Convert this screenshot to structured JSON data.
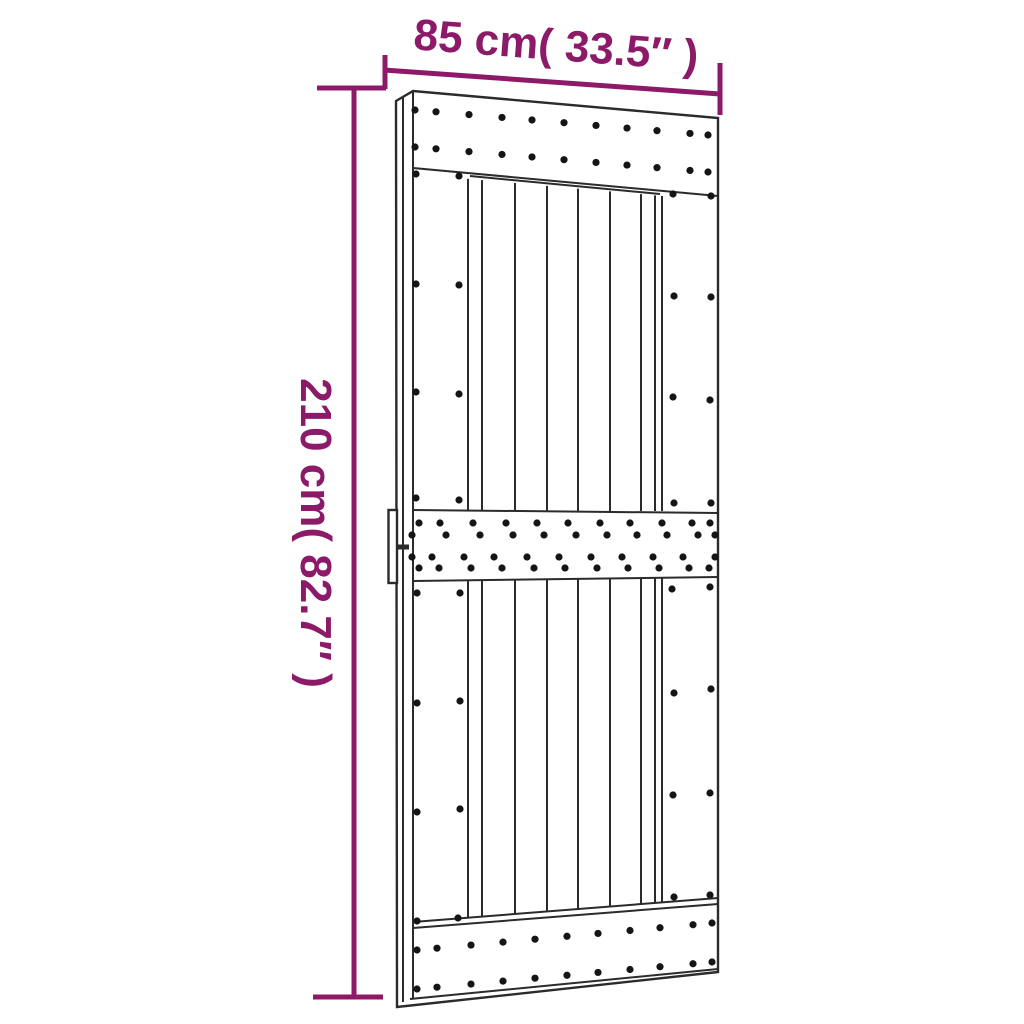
{
  "page": {
    "background": "#ffffff"
  },
  "colors": {
    "accent": "#8C1A69",
    "line": "#2b2b2b",
    "dot": "#151515"
  },
  "dimensions": {
    "width": {
      "label": "85 cm( 33.5″ )"
    },
    "height": {
      "label": "210 cm( 82.7″ )"
    }
  }
}
